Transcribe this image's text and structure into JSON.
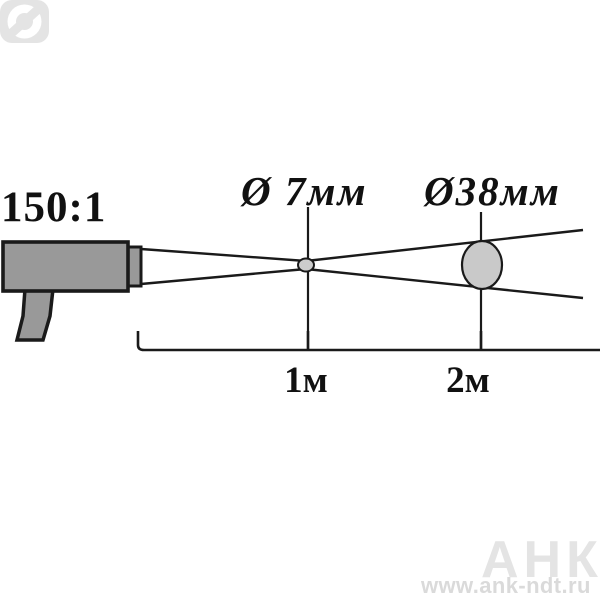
{
  "diagram": {
    "type": "pyrometer-optical-resolution",
    "optical_ratio_label": "150:1",
    "spots": [
      {
        "label": "Ø 7мм",
        "diameter_mm": 7,
        "distance_label": "1м",
        "distance_m": 1
      },
      {
        "label": "Ø38мм",
        "diameter_mm": 38,
        "distance_label": "2м",
        "distance_m": 2
      }
    ]
  },
  "watermark": {
    "brand": "АНК",
    "logo_icon": "diameter-symbol-badge",
    "url": "www.ank-ndt.ru"
  },
  "colors": {
    "background": "#ffffff",
    "outline": "#1a1a1a",
    "device_fill": "#999999",
    "spot_fill": "#cccccc",
    "ellipse_fill": "#c9c9c9",
    "watermark_fill": "#e4e4e4",
    "watermark_url": "#dadada"
  }
}
